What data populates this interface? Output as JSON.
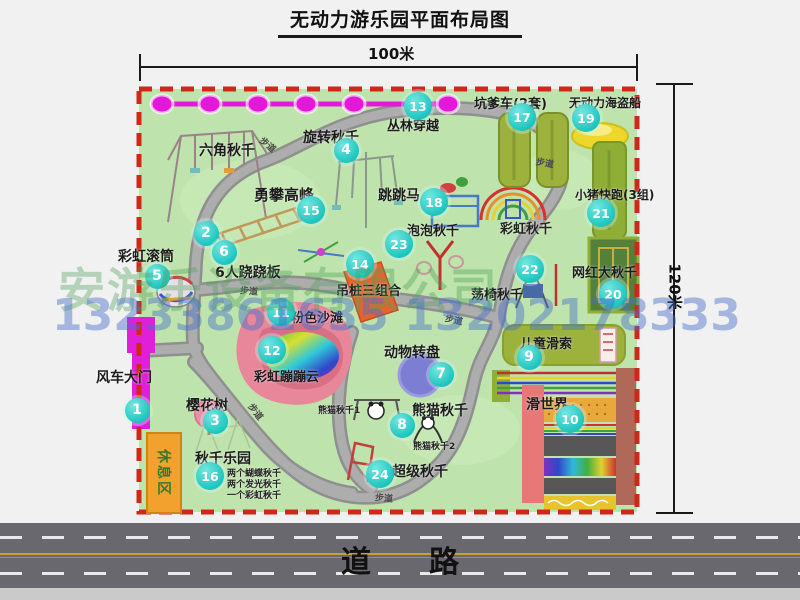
{
  "title": "无动力游乐园平面布局图",
  "dimensions": {
    "width": "100米",
    "height": "120米"
  },
  "road": {
    "label": "道路"
  },
  "watermarks": {
    "company": "安游乐设备有限公司",
    "phone": "13233861635 13202178333"
  },
  "park": {
    "rest_area_label": "休息区",
    "markers": [
      {
        "num": "1",
        "label": "风车大门",
        "cx": 137,
        "cy": 410,
        "lx": 96,
        "ly": 367,
        "fs": 14
      },
      {
        "num": "2",
        "label": "六角秋千",
        "cx": 206,
        "cy": 233,
        "lx": 199,
        "ly": 140,
        "fs": 14
      },
      {
        "num": "3",
        "label": "樱花树",
        "cx": 215,
        "cy": 421,
        "lx": 186,
        "ly": 395,
        "fs": 14
      },
      {
        "num": "4",
        "label": "旋转秋千",
        "cx": 346,
        "cy": 150,
        "lx": 303,
        "ly": 127,
        "fs": 14
      },
      {
        "num": "5",
        "label": "彩虹滚筒",
        "cx": 157,
        "cy": 276,
        "lx": 118,
        "ly": 246,
        "fs": 14
      },
      {
        "num": "6",
        "label": "6人跷跷板",
        "cx": 224,
        "cy": 252,
        "lx": 215,
        "ly": 262,
        "fs": 14
      },
      {
        "num": "7",
        "label": "动物转盘",
        "cx": 441,
        "cy": 374,
        "lx": 384,
        "ly": 342,
        "fs": 14
      },
      {
        "num": "8",
        "label": "熊猫秋千",
        "cx": 402,
        "cy": 425,
        "lx": 412,
        "ly": 400,
        "fs": 14
      },
      {
        "num": "9",
        "label": "儿童滑索",
        "cx": 529,
        "cy": 357,
        "lx": 520,
        "ly": 333,
        "fs": 13
      },
      {
        "num": "10",
        "label": "滑世界",
        "cx": 570,
        "cy": 419,
        "lx": 526,
        "ly": 394,
        "fs": 14
      },
      {
        "num": "11",
        "label": "粉色沙滩",
        "cx": 281,
        "cy": 312,
        "lx": 291,
        "ly": 307,
        "fs": 13
      },
      {
        "num": "12",
        "label": "彩虹蹦蹦云",
        "cx": 272,
        "cy": 350,
        "lx": 254,
        "ly": 366,
        "fs": 13
      },
      {
        "num": "13",
        "label": "丛林穿越",
        "cx": 418,
        "cy": 106,
        "lx": 387,
        "ly": 115,
        "fs": 13
      },
      {
        "num": "14",
        "label": "吊桩三组合",
        "cx": 360,
        "cy": 264,
        "lx": 336,
        "ly": 280,
        "fs": 13
      },
      {
        "num": "15",
        "label": "勇攀高峰",
        "cx": 311,
        "cy": 210,
        "lx": 254,
        "ly": 184,
        "fs": 15
      },
      {
        "num": "16",
        "label": "秋千乐园",
        "cx": 210,
        "cy": 476,
        "lx": 195,
        "ly": 448,
        "fs": 14
      },
      {
        "num": "17",
        "label": "坑爹车(2套)",
        "cx": 522,
        "cy": 117,
        "lx": 474,
        "ly": 93,
        "fs": 13
      },
      {
        "num": "18",
        "label": "跳跳马",
        "cx": 434,
        "cy": 202,
        "lx": 378,
        "ly": 185,
        "fs": 14
      },
      {
        "num": "19",
        "label": "无动力海盗船",
        "cx": 586,
        "cy": 118,
        "lx": 569,
        "ly": 94,
        "fs": 12
      },
      {
        "num": "20",
        "label": "网红大秋千",
        "cx": 613,
        "cy": 294,
        "lx": 572,
        "ly": 262,
        "fs": 13
      },
      {
        "num": "21",
        "label": "小猪快跑(3组)",
        "cx": 601,
        "cy": 213,
        "lx": 575,
        "ly": 186,
        "fs": 12
      },
      {
        "num": "22",
        "label": "荡椅秋千",
        "cx": 530,
        "cy": 269,
        "lx": 471,
        "ly": 284,
        "fs": 13
      },
      {
        "num": "23",
        "label": "泡泡秋千",
        "cx": 399,
        "cy": 244,
        "lx": 407,
        "ly": 220,
        "fs": 13
      },
      {
        "num": "24",
        "label": "超级秋千",
        "cx": 380,
        "cy": 474,
        "lx": 392,
        "ly": 461,
        "fs": 14
      }
    ],
    "notes": [
      {
        "text": "彩虹秋千",
        "x": 500,
        "y": 218,
        "fs": 13
      },
      {
        "text": "熊猫秋千1",
        "x": 318,
        "y": 403,
        "fs": 9
      },
      {
        "text": "熊猫秋千2",
        "x": 413,
        "y": 439,
        "fs": 9
      },
      {
        "text": "两个蝴蝶秋千",
        "x": 227,
        "y": 466,
        "fs": 9
      },
      {
        "text": "两个发光秋千",
        "x": 227,
        "y": 477,
        "fs": 9
      },
      {
        "text": "一个彩虹秋千",
        "x": 227,
        "y": 488,
        "fs": 9
      }
    ],
    "trail_label_text": "步道",
    "trail_labels": [
      {
        "x": 259,
        "y": 138,
        "rot": 40
      },
      {
        "x": 536,
        "y": 156,
        "rot": 10
      },
      {
        "x": 240,
        "y": 284,
        "rot": 5
      },
      {
        "x": 445,
        "y": 313,
        "rot": 12
      },
      {
        "x": 247,
        "y": 405,
        "rot": 52
      },
      {
        "x": 375,
        "y": 491,
        "rot": 5
      }
    ]
  },
  "colors": {
    "park_green": "#bfe3ac",
    "border_red": "#d02818",
    "path_gray": "#a2a2a2",
    "badge_teal": "#1cc4be",
    "zipline_magenta": "#e318d8",
    "gate_magenta": "#e020d8",
    "rest_area_orange": "#f2a12f",
    "road_gray": "#68686e",
    "road_yellow": "#c0a23a"
  }
}
